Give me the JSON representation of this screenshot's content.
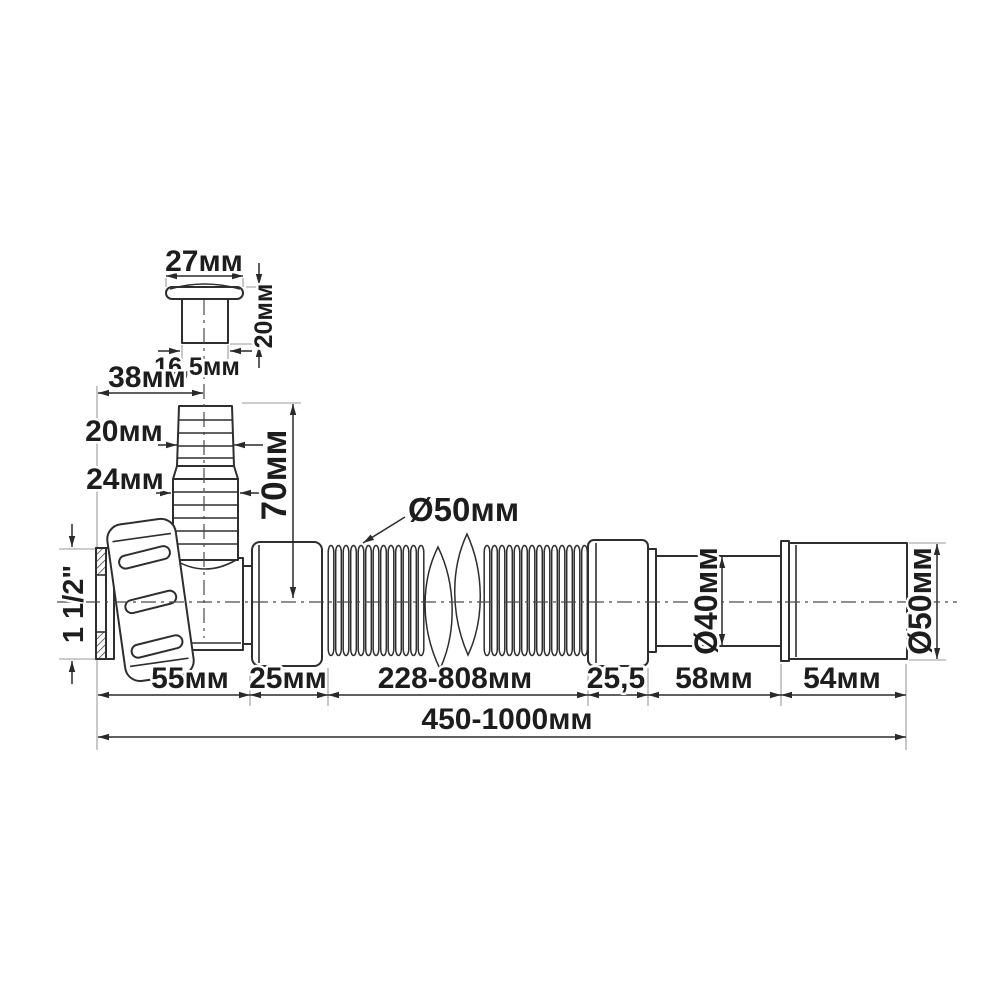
{
  "colors": {
    "background": "#ffffff",
    "ink": "#2e2e2e",
    "dimension_lines": "#2a2a2a",
    "extension_lines": "#9a9a9a",
    "text": "#1d1d1d"
  },
  "cap_detail": {
    "width": "27мм",
    "height": "20мм",
    "stem_width": "16,5мм"
  },
  "branch": {
    "offset": "38мм",
    "upper_barb_diameter": "20мм",
    "lower_barb_diameter": "24мм",
    "height": "70мм"
  },
  "inlet": {
    "thread_size": "1 1/2\""
  },
  "hose": {
    "corrugation_diameter": "Ø50мм"
  },
  "outlet": {
    "mid_pipe_diameter": "Ø40мм",
    "end_pipe_diameter": "Ø50мм"
  },
  "chain": {
    "inlet_nut": "55мм",
    "first_collar": "25мм",
    "corrugation": "228-808мм",
    "second_collar": "25,5",
    "mid_pipe": "58мм",
    "end_pipe": "54мм",
    "overall": "450-1000мм"
  }
}
